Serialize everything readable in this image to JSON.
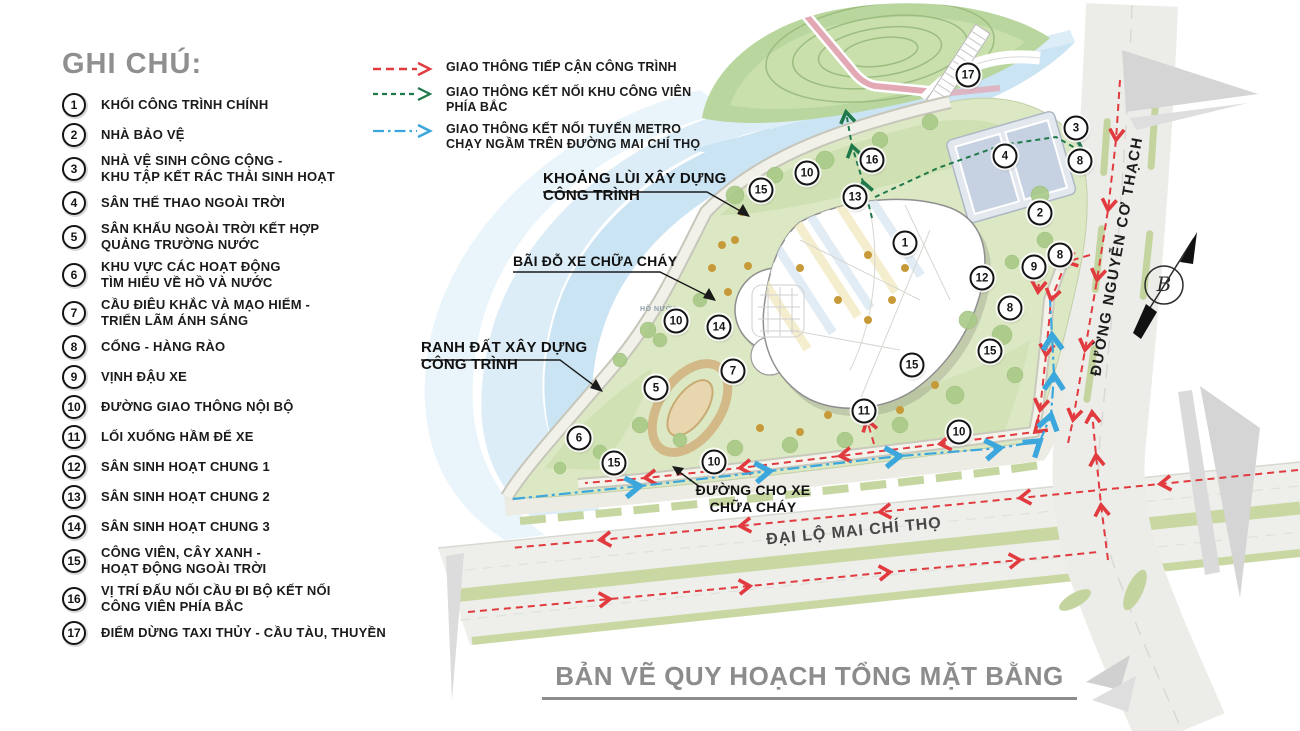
{
  "colors": {
    "accent_red": "#e13a3f",
    "accent_green": "#20794b",
    "accent_blue": "#3ba7dc",
    "title_gray": "#8c8c8c",
    "text_black": "#1b1b1b",
    "water_blue": "#cbe4f4",
    "park_green": "#b9d69e",
    "site_green": "#dce8c3",
    "road_gray": "#ecece9",
    "median_green": "#c9d8a3"
  },
  "legend": {
    "title": "GHI CHÚ:",
    "items": [
      {
        "num": "1",
        "label": "KHỐI CÔNG TRÌNH CHÍNH"
      },
      {
        "num": "2",
        "label": "NHÀ BẢO VỆ"
      },
      {
        "num": "3",
        "label": "NHÀ VỆ SINH CÔNG CỘNG -\nKHU TẬP KẾT RÁC THẢI SINH HOẠT"
      },
      {
        "num": "4",
        "label": "SÂN THỂ THAO NGOÀI TRỜI"
      },
      {
        "num": "5",
        "label": "SÂN KHẤU NGOÀI TRỜI KẾT HỢP\nQUẢNG TRƯỜNG NƯỚC"
      },
      {
        "num": "6",
        "label": "KHU VỰC CÁC HOẠT ĐỘNG\nTÌM HIỂU VỀ HỒ VÀ NƯỚC"
      },
      {
        "num": "7",
        "label": "CẦU ĐIÊU KHẮC VÀ MẠO HIỂM -\nTRIỂN LÃM ÁNH SÁNG"
      },
      {
        "num": "8",
        "label": "CỔNG - HÀNG RÀO"
      },
      {
        "num": "9",
        "label": "VỊNH ĐẬU XE"
      },
      {
        "num": "10",
        "label": "ĐƯỜNG GIAO THÔNG NỘI BỘ"
      },
      {
        "num": "11",
        "label": "LỐI XUỐNG HẦM ĐỂ XE"
      },
      {
        "num": "12",
        "label": "SÂN SINH HOẠT CHUNG 1"
      },
      {
        "num": "13",
        "label": "SÂN SINH HOẠT CHUNG 2"
      },
      {
        "num": "14",
        "label": "SÂN SINH HOẠT CHUNG 3"
      },
      {
        "num": "15",
        "label": "CÔNG VIÊN, CÂY XANH -\nHOẠT ĐỘNG NGOÀI TRỜI"
      },
      {
        "num": "16",
        "label": "VỊ TRÍ ĐẤU NỐI CẦU ĐI BỘ KẾT NỐI\nCÔNG VIÊN PHÍA BẮC"
      },
      {
        "num": "17",
        "label": "ĐIỂM DỪNG TAXI THỦY - CẦU TÀU, THUYỀN"
      }
    ]
  },
  "traffic_legend": {
    "items": [
      {
        "style": "red-dashed",
        "color": "#e13a3f",
        "label": "GIAO THÔNG TIẾP CẬN CÔNG TRÌNH"
      },
      {
        "style": "green-dashed",
        "color": "#20794b",
        "label": "GIAO THÔNG KẾT NỐI KHU CÔNG VIÊN\nPHÍA BẮC"
      },
      {
        "style": "blue-dashdot",
        "color": "#3ba7dc",
        "label": "GIAO THÔNG KẾT NỐI TUYẾN METRO\nCHẠY NGẦM TRÊN ĐƯỜNG MAI CHÍ THỌ"
      }
    ]
  },
  "map": {
    "annotations": {
      "setback": "KHOẢNG LÙI XÂY DỰNG\nCÔNG TRÌNH",
      "fire_parking": "BÃI ĐỖ XE CHỮA CHÁY",
      "boundary": "RANH ĐẤT XÂY DỰNG\nCÔNG TRÌNH",
      "fire_lane": "ĐƯỜNG CHO XE\nCHỮA CHÁY",
      "lake": "HỒ NƯỚC"
    },
    "roads": {
      "mai_chi_tho": "ĐẠI LỘ MAI CHÍ THỌ",
      "nguyen_co_thach": "ĐƯỜNG NGUYỄN CƠ THẠCH"
    },
    "north_arrow_label": "B",
    "markers": [
      {
        "n": "17",
        "x": 968,
        "y": 75
      },
      {
        "n": "3",
        "x": 1076,
        "y": 128
      },
      {
        "n": "8",
        "x": 1080,
        "y": 161
      },
      {
        "n": "4",
        "x": 1005,
        "y": 156
      },
      {
        "n": "16",
        "x": 872,
        "y": 160
      },
      {
        "n": "10",
        "x": 807,
        "y": 173
      },
      {
        "n": "15",
        "x": 761,
        "y": 190
      },
      {
        "n": "13",
        "x": 855,
        "y": 197
      },
      {
        "n": "2",
        "x": 1040,
        "y": 213
      },
      {
        "n": "1",
        "x": 905,
        "y": 243
      },
      {
        "n": "8",
        "x": 1060,
        "y": 255
      },
      {
        "n": "9",
        "x": 1034,
        "y": 267
      },
      {
        "n": "12",
        "x": 982,
        "y": 278
      },
      {
        "n": "8",
        "x": 1010,
        "y": 308
      },
      {
        "n": "10",
        "x": 676,
        "y": 321
      },
      {
        "n": "14",
        "x": 719,
        "y": 327
      },
      {
        "n": "15",
        "x": 990,
        "y": 351
      },
      {
        "n": "15",
        "x": 912,
        "y": 365
      },
      {
        "n": "7",
        "x": 733,
        "y": 371
      },
      {
        "n": "5",
        "x": 656,
        "y": 388
      },
      {
        "n": "11",
        "x": 864,
        "y": 411
      },
      {
        "n": "10",
        "x": 959,
        "y": 432
      },
      {
        "n": "6",
        "x": 579,
        "y": 438
      },
      {
        "n": "10",
        "x": 714,
        "y": 462
      },
      {
        "n": "15",
        "x": 614,
        "y": 463
      }
    ]
  },
  "title": "BẢN VẼ QUY HOẠCH TỔNG MẶT BẰNG"
}
